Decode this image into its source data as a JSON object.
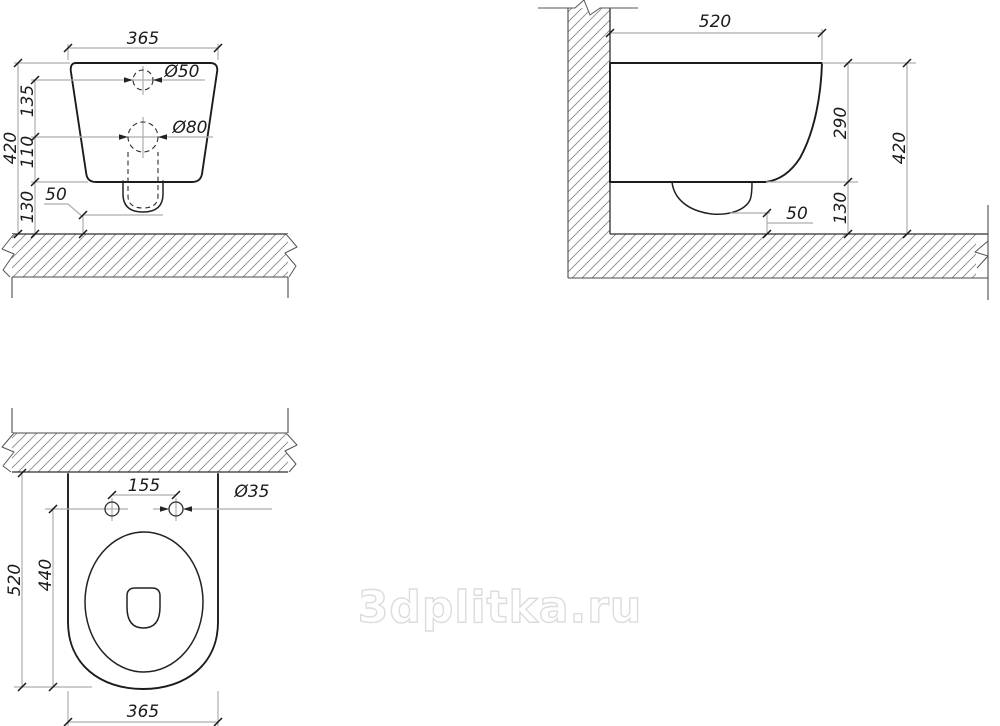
{
  "watermark": "3dplitka.ru",
  "front": {
    "width": "365",
    "inlet_dia": "Ø50",
    "outlet_dia": "Ø80",
    "seg_top": "135",
    "seg_mid": "110",
    "seg_bottom": "130",
    "height": "420",
    "clearance": "50"
  },
  "side": {
    "depth": "520",
    "bowl_height": "290",
    "height": "420",
    "gap": "130",
    "clearance": "50"
  },
  "top": {
    "length": "520",
    "inner_length": "440",
    "width": "365",
    "hole_spacing": "155",
    "hole_dia": "Ø35"
  }
}
